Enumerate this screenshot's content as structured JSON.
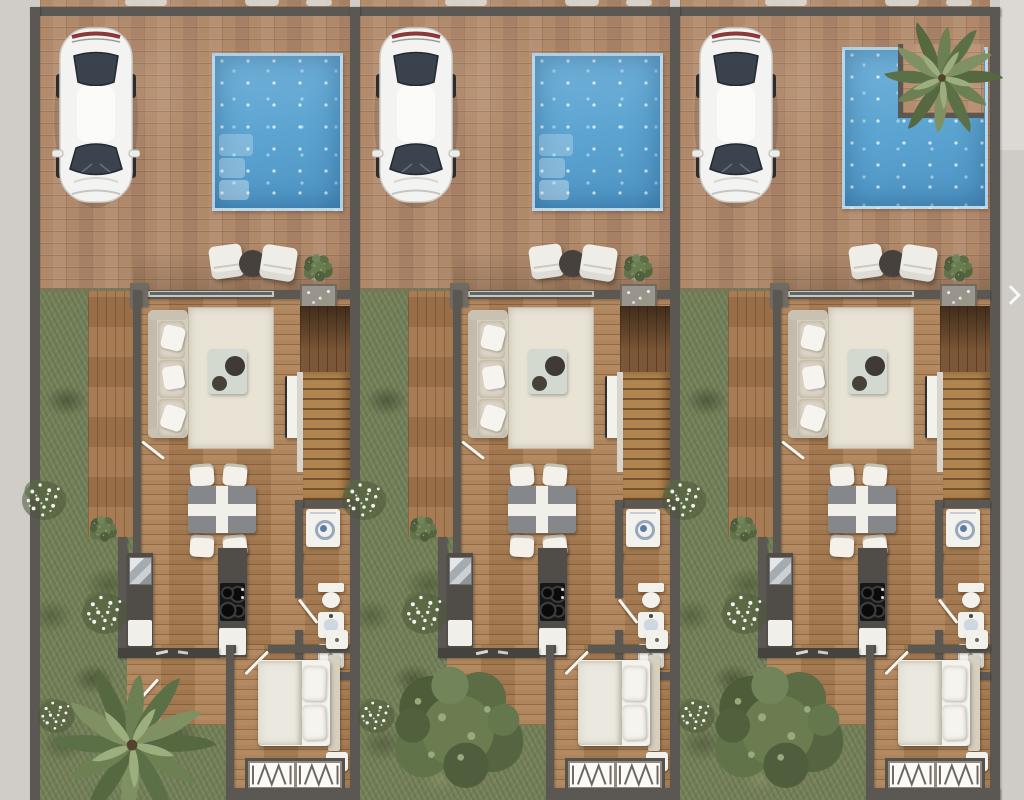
{
  "scene": {
    "description": "Top-down architectural render: three identical attached townhouse units, each with driveway, parked white car, swimming pool, lounge terrace, living-dining-kitchen floor, bathroom, bedroom and side garden",
    "units_count": 3,
    "carousel_next_icon": "chevron-right"
  },
  "labels": {
    "canvas": "Residential floor plan render",
    "unit": "Townhouse unit",
    "car": "White car on driveway",
    "pool": "Swimming pool",
    "pool_steps": "Pool steps",
    "pool_planter": "Pool corner planter with palm",
    "lounge": "Outdoor lounge chairs and side table",
    "plant_pot": "Potted plant",
    "planter_box": "Flower planter",
    "garden": "Side garden",
    "deck": "Wooden side deck",
    "living": "Living room",
    "sofa": "Three-seat sofa with pillows",
    "rug": "Area rug",
    "coffee_table": "Coffee table with trays",
    "tv": "TV cabinet",
    "stairs": "Staircase",
    "washer": "Washing machine",
    "bathroom": "Bathroom",
    "toilet": "Toilet",
    "vanity": "Washbasin",
    "shower": "Shower tray",
    "dining": "Dining table for four",
    "kitchen_counter": "Kitchen counter with sink",
    "kitchen_island": "Kitchen island with cooktop",
    "bedroom": "Bedroom",
    "bed": "Double bed",
    "nightstand": "Nightstand",
    "wardrobe": "Wardrobe with hangers",
    "palm": "Palm tree",
    "bush": "Garden shrub",
    "flowers": "Flowering plants",
    "next": "Next image"
  },
  "palette": {
    "sidewalk": "#d0cdc8",
    "wall": "#5b5853",
    "brick": "#b0886a",
    "wood": "#a97d52",
    "deck": "#a2754c",
    "grass": "#75815a",
    "pool1": "#74b3da",
    "pool2": "#4c93c4",
    "white": "#f2f1ec",
    "rug": "#e8e3d5",
    "sofa": "#d5cdbe",
    "counter": "#504d49",
    "table": "#85878b",
    "linen": "#f4f2ed",
    "headboard": "#d6cfc0",
    "green_dark": "#4d5d3a",
    "green_mid": "#6b7d50",
    "green_light": "#93a474",
    "flower": "#f2f0ea"
  },
  "units": [
    {
      "id": "unit-1",
      "label": "Unit 1",
      "x": 30,
      "pool": "rectangular",
      "pool_steps": true,
      "garden_tree": "palm"
    },
    {
      "id": "unit-2",
      "label": "Unit 2",
      "x": 350,
      "pool": "rectangular",
      "pool_steps": true,
      "garden_tree": "bush"
    },
    {
      "id": "unit-3",
      "label": "Unit 3",
      "x": 670,
      "pool": "l_shaped_corner_planter",
      "pool_steps": false,
      "garden_tree": "bush"
    }
  ]
}
